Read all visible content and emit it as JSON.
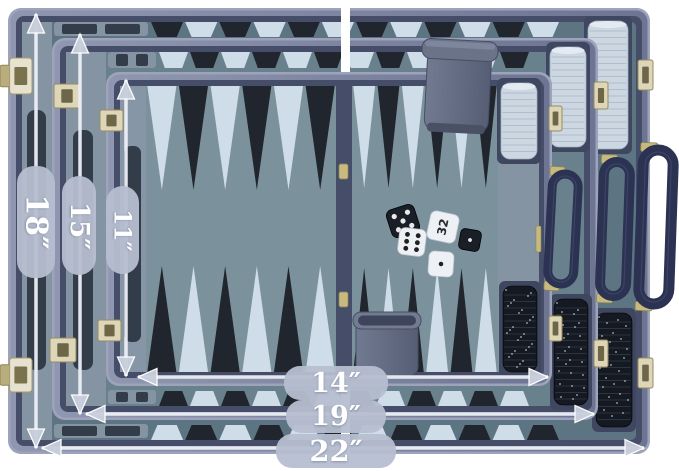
{
  "dimensions": {
    "height_large": "18″",
    "height_medium": "15″",
    "height_small": "11″",
    "width_small": "14″",
    "width_medium": "19″",
    "width_large": "22″"
  },
  "scene": {
    "cases": [
      "large",
      "medium",
      "small"
    ],
    "dice": [
      {
        "color": "black",
        "value": 5
      },
      {
        "color": "white",
        "value": 6
      },
      {
        "color": "black",
        "value": 1
      },
      {
        "color": "white",
        "value": 1
      }
    ],
    "doubling_cube": {
      "color": "white",
      "value": "32"
    },
    "checkers": {
      "white_stacks": 3,
      "black_stacks": 3
    },
    "dice_cups": 2,
    "handles": 3
  },
  "palette": {
    "background": "#ffffff",
    "case_edge_light": "#9ca3ba",
    "case_wall": "#7a82a0",
    "case_lip": "#454d68",
    "board_large": "#5d7582",
    "board_medium": "#69818d",
    "board_small": "#7b929c",
    "rail": "#8494a3",
    "rail_small": "#8796a6",
    "slot": "#333c49",
    "point_light": "#cfdde9",
    "point_dark": "#21252e",
    "tray": "#3f4760",
    "checker_white": "#ccd7e1",
    "checker_white_line": "#a9b8c7",
    "checker_black": "#151922",
    "checker_black_line": "#2c3440",
    "cup_light": "#727b92",
    "cup_dark": "#565e75",
    "handle": "#2b3252",
    "gold": "#c8ba7e",
    "gold_dark": "#8f8557",
    "dice_white": "#edf0f4",
    "dice_black": "#1a1e26",
    "pill_bg": "#b6bed0",
    "pill_text": "#ffffff",
    "arrow_shaft": "#eef0f6",
    "arrow_head": "#c9cfdc"
  }
}
